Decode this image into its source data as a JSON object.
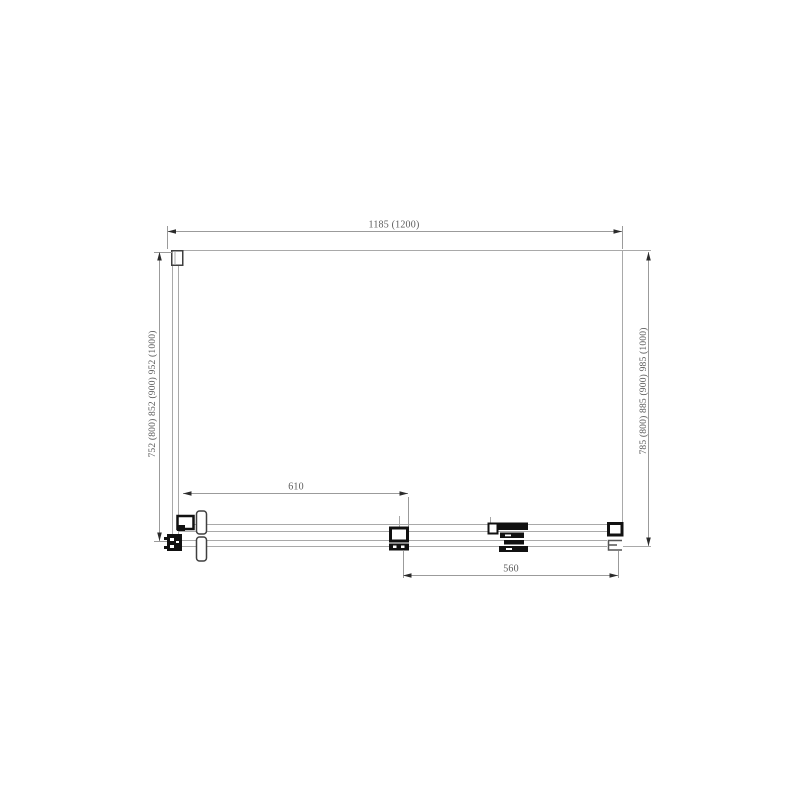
{
  "dimensions": {
    "top_width": "1185 (1200)",
    "left_height": "752 (800)  852 (900)  952 (1000)",
    "right_height": "785 (800)  885 (900)  985 (1000)",
    "inner_width": "610",
    "bottom_width": "560"
  },
  "colors": {
    "background": "#ffffff",
    "outline": "#a9a9a9",
    "dimension_line": "#9b9b9b",
    "arrow": "#2b2b2b",
    "hardware": "#111111",
    "detail_stroke": "#3f3f3f",
    "text": "#5a5a5a"
  }
}
